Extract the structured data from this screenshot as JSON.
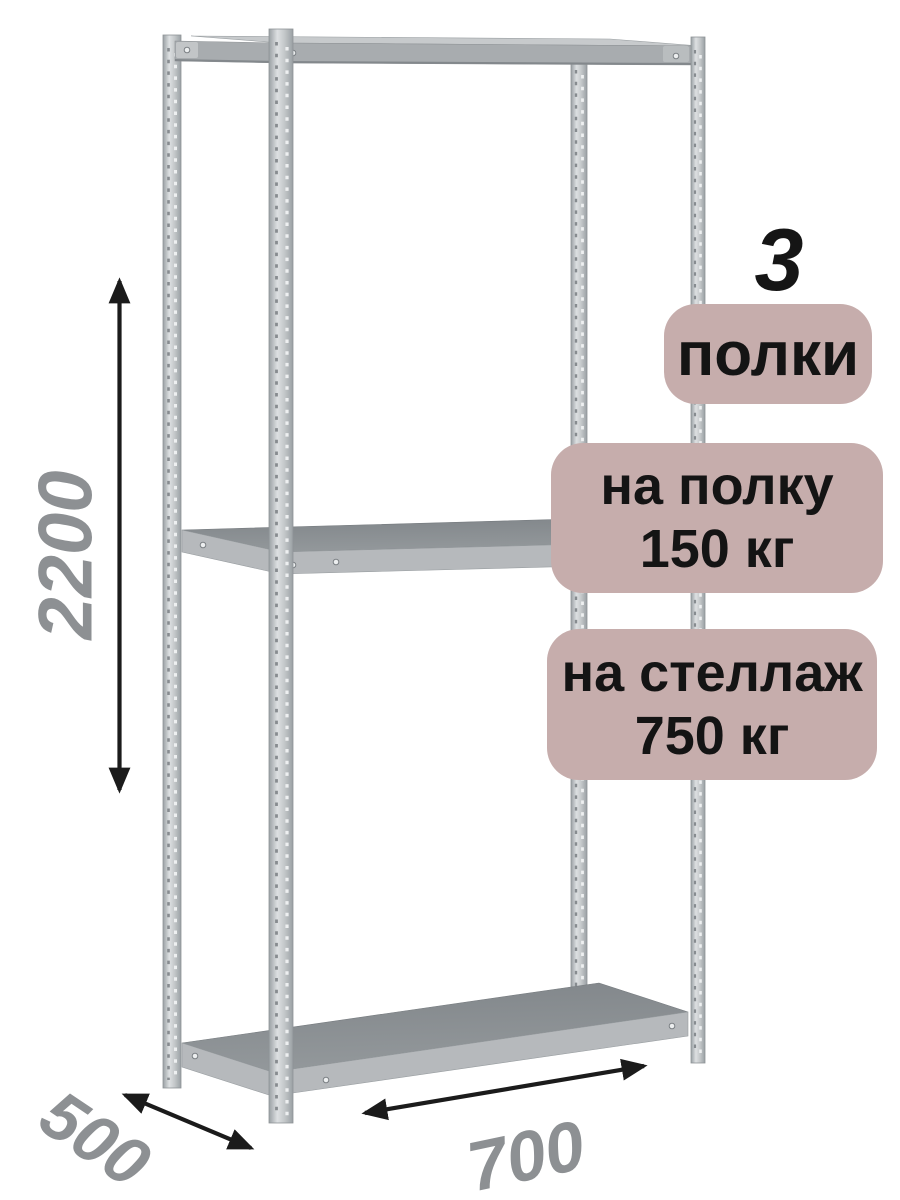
{
  "dimensions": {
    "height": "2200",
    "depth": "500",
    "width": "700"
  },
  "badges": {
    "shelf_count": {
      "number": "3",
      "label": "полки"
    },
    "shelf_load": {
      "line1": "на полку",
      "line2": "150 кг"
    },
    "rack_load": {
      "line1": "на стеллаж",
      "line2": "750 кг"
    }
  },
  "colors": {
    "background": "#ffffff",
    "badge_bg": "#c6adac",
    "badge_text": "#141414",
    "number_text": "#151515",
    "dimension_text": "#8d9093",
    "arrow": "#1b1b1b",
    "metal_edge": "#9aa0a4",
    "metal_highlight": "#dde0e2",
    "metal_mid": "#c3c7c9",
    "shelf_surface_dark": "#81868a",
    "shelf_surface": "#93989b",
    "shelf_edge": "#b6b9bc",
    "shelf_top_light": "#c7cacc",
    "top_beam": "#a8acaf"
  }
}
